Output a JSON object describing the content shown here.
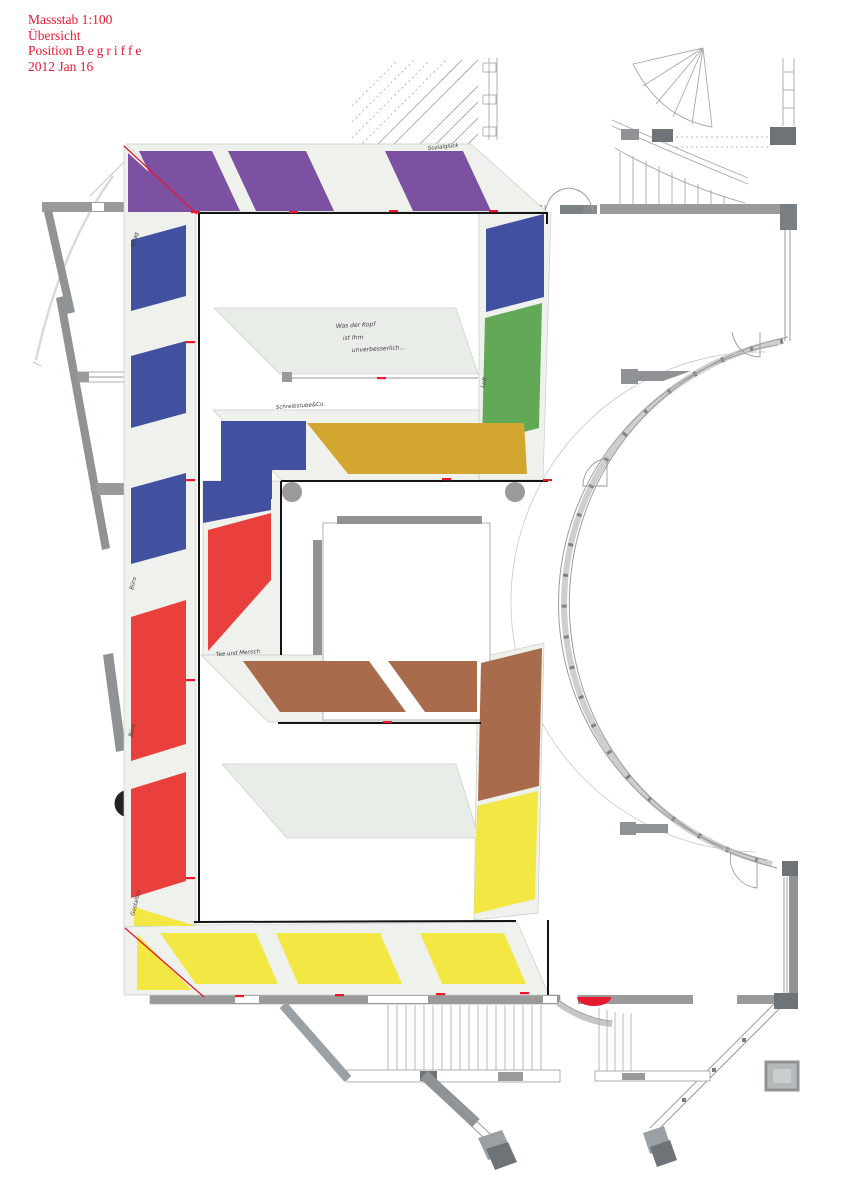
{
  "title_block": {
    "scale": "Massstab 1:100",
    "view": "Übersicht",
    "position_label": "Position",
    "position_value": "Begriffe",
    "date": "2012 Jan 16"
  },
  "colors": {
    "accent_red": "#e8192f",
    "purple": "#7c51a1",
    "blue": "#41509f",
    "green": "#61a956",
    "gold": "#d2a62f",
    "red": "#ea403d",
    "brown": "#a86c4c",
    "yellow": "#f3e843",
    "band": "#eef1ec",
    "band_stroke": "#c9cec8",
    "platform": "#e9ede7",
    "wall": "#8f9396",
    "wall_dark": "#6e7377",
    "line": "#9b9b9b",
    "ink": "#161616"
  },
  "labels": {
    "top_bar": "Sozialglück",
    "left_top": "Alltag",
    "left_mid": "Büro",
    "left_low": "Büro",
    "left_bottom": "Gestalten",
    "gold_bar": "Schreibstube&Co.",
    "brown_bar": "Tee und Mensch",
    "right_col": "Luft"
  },
  "platform_note": {
    "line1": "Was der Kopf",
    "line2": "ist Ihm",
    "line3": "unverbesserlich..."
  },
  "panels": [
    {
      "id": "purple-corner",
      "color": "purple",
      "points": "128,153 193,212 128,212"
    },
    {
      "id": "purple-1",
      "color": "purple",
      "points": "139,151 212,151 240,211 167,211"
    },
    {
      "id": "purple-2",
      "color": "purple",
      "points": "228,151 306,151 334,211 256,211"
    },
    {
      "id": "purple-3",
      "color": "purple",
      "points": "385,151 463,151 491,211 413,211"
    },
    {
      "id": "blue-1",
      "color": "blue",
      "points": "131,240 186,225 186,296 131,311"
    },
    {
      "id": "blue-2",
      "color": "blue",
      "points": "131,356 186,341 186,413 131,428"
    },
    {
      "id": "blue-3",
      "color": "blue",
      "points": "131,488 186,473 186,549 131,564"
    },
    {
      "id": "red-1",
      "color": "red",
      "points": "131,617 186,600 186,744 131,761"
    },
    {
      "id": "red-2",
      "color": "red",
      "points": "131,789 186,772 186,881 131,898"
    },
    {
      "id": "yellow-corner-a",
      "color": "yellow",
      "points": "134,907 196,926 134,926"
    },
    {
      "id": "yellow-corner-b",
      "color": "yellow",
      "points": "137,934 192,990 137,990"
    },
    {
      "id": "yellow-1",
      "color": "yellow",
      "points": "160,933 256,933 278,984 196,984"
    },
    {
      "id": "yellow-2",
      "color": "yellow",
      "points": "276,933 380,933 402,984 298,984"
    },
    {
      "id": "yellow-3",
      "color": "yellow",
      "points": "420,933 504,933 526,984 442,984"
    },
    {
      "id": "right-blue",
      "color": "blue",
      "points": "486,229 544,214 544,297 486,312"
    },
    {
      "id": "right-green",
      "color": "green",
      "points": "485,318 542,303 539,428 482,443"
    },
    {
      "id": "gold-1",
      "color": "gold",
      "points": "307,423 524,423 527,474 348,474"
    },
    {
      "id": "blue-L",
      "color": "blue",
      "points": "221,421 306,421 306,470 272,470 272,499 221,499"
    },
    {
      "id": "blue-connector",
      "color": "blue",
      "points": "203,481 271,481 271,510 203,523"
    },
    {
      "id": "red-connector",
      "color": "red",
      "points": "208,530 271,513 271,580 208,651"
    },
    {
      "id": "brown-1",
      "color": "brown",
      "points": "243,661 369,661 406,712 280,712"
    },
    {
      "id": "brown-2",
      "color": "brown",
      "points": "388,661 477,661 477,712 425,712"
    },
    {
      "id": "right-brown",
      "color": "brown",
      "points": "481,663 542,648 539,786 478,801"
    },
    {
      "id": "right-yellow",
      "color": "yellow",
      "points": "477,806 538,791 535,899 474,914"
    }
  ],
  "red_marks": [
    [
      191,
      211
    ],
    [
      289,
      211
    ],
    [
      389,
      210
    ],
    [
      489,
      210
    ],
    [
      186,
      341
    ],
    [
      186,
      479
    ],
    [
      186,
      679
    ],
    [
      186,
      877
    ],
    [
      235,
      995
    ],
    [
      335,
      994
    ],
    [
      436,
      993
    ],
    [
      520,
      992
    ],
    [
      377,
      377
    ],
    [
      442,
      478
    ],
    [
      383,
      721
    ],
    [
      543,
      479
    ]
  ]
}
